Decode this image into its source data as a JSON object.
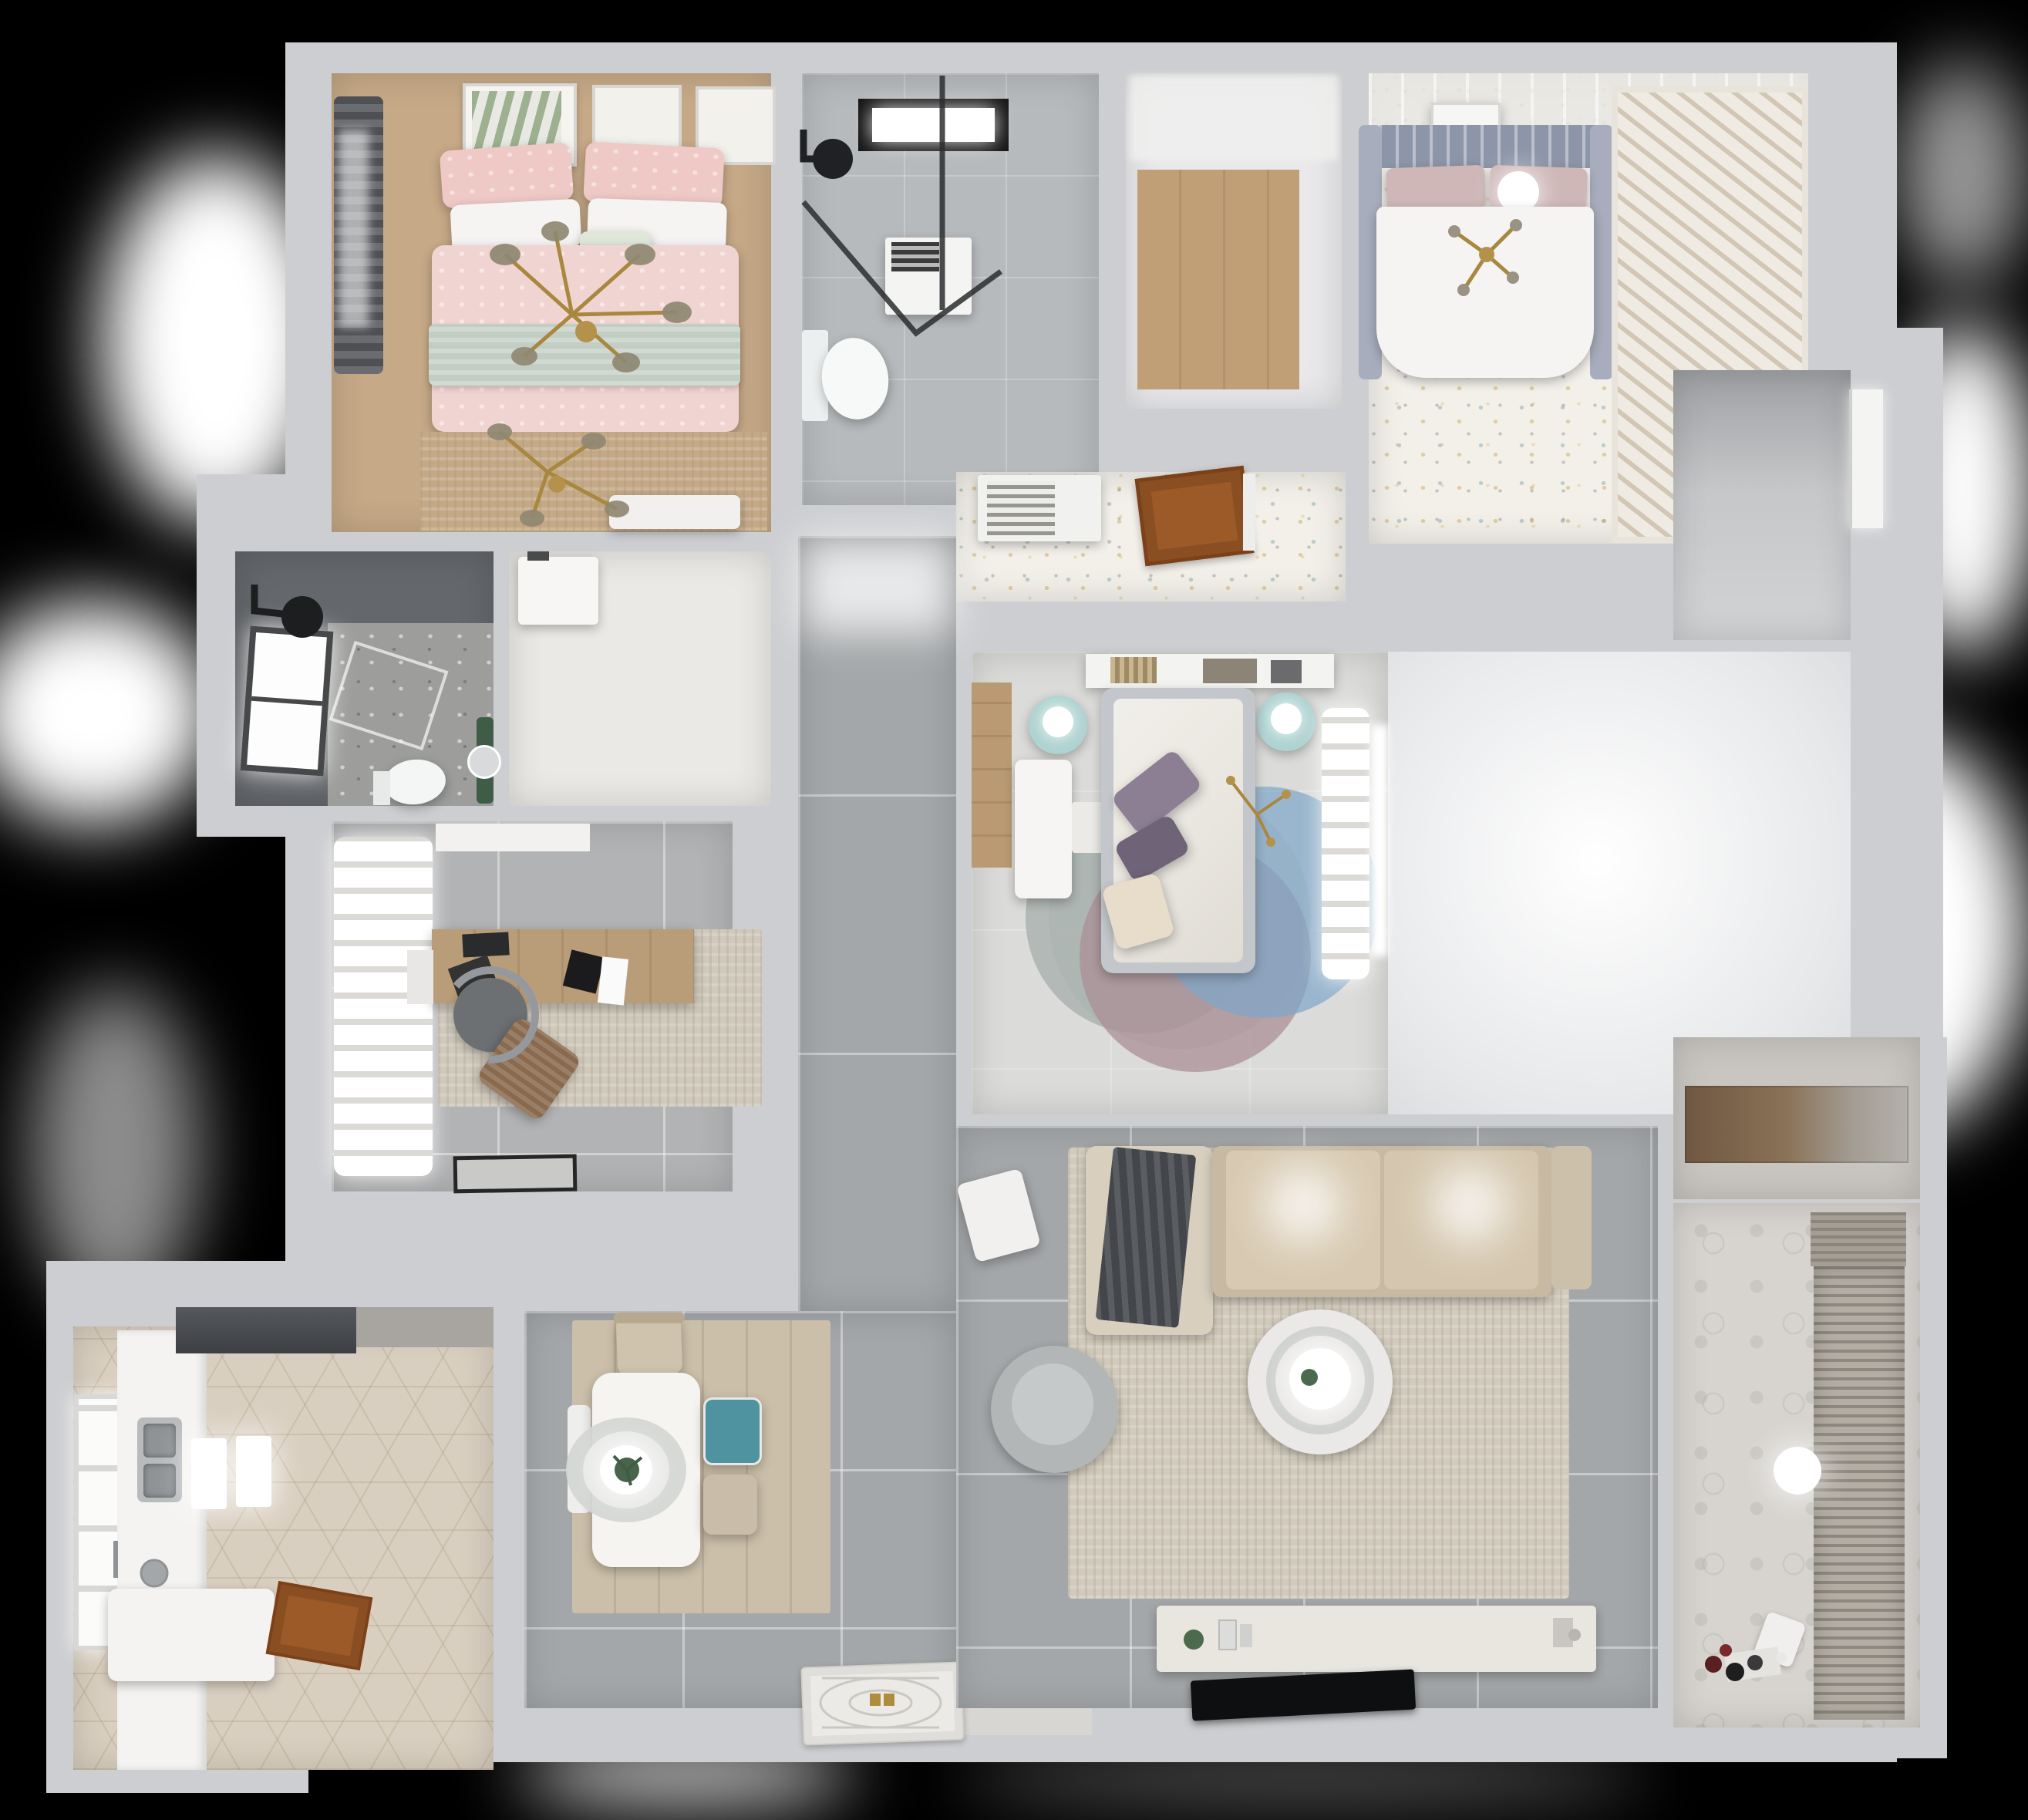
{
  "scene": {
    "description": "Top-down 3D rendered dollhouse floor plan of a furnished apartment on a black background",
    "background_color": "#000000",
    "visible_text": "none"
  },
  "palette": {
    "bg": "#000000",
    "wall": "#cdced1",
    "wallLight": "#e9e9eb",
    "woodFloor": "#c6a987",
    "woodFloor2": "#c09e76",
    "tileGray": "#a4a7a9",
    "tileLight": "#b7babd",
    "tileStudy": "#b2b3b4",
    "bedroom3Floor": "#dbdbd9",
    "darkTile": "#64676b",
    "terrazzoBase": "#9d9e9c",
    "speckleBase": "#f3f0ea",
    "kitchenFloor": "#d9cfc0",
    "balconyFloor": "#d7d4d0",
    "rugTan": "#c5a987",
    "rugBeige": "#cfc8bb",
    "livingRug": "#d2cbbd",
    "pinkDuvet": "#f0d4d1",
    "pinkPillow": "#eec9c6",
    "sageBlanket": "#c2cdc3",
    "whiteSoft": "#f5f4f2",
    "sofaTan": "#c8baa2",
    "sofaChaise": "#d8cfbf",
    "blanketDark": "#43464a",
    "tealChair": "#4f93a0",
    "chairBeige": "#c9bda9",
    "tealStand": "#aed3d1",
    "purplePillow": "#8d7f93",
    "purplePillow2": "#6f6377",
    "creamPillow": "#e8dccb",
    "gold": "#b5924c",
    "doorBrown": "#9c5a28",
    "deskWood": "#b99d79",
    "monitorBlack": "#1b1b1d",
    "hoodDark": "#4b4e52",
    "glassDark": "#2c2d2f",
    "rugBlue": "#7fa6c9",
    "rugMauve": "#a98f96",
    "rugGrayGreen": "#a7b0ac",
    "plantGreen": "#3f5d46"
  },
  "rooms": [
    {
      "id": "bedroom-1",
      "label": "Bedroom 1 (pink bed)"
    },
    {
      "id": "bathroom-1",
      "label": "Bathroom with skylight"
    },
    {
      "id": "walk-in-closet",
      "label": "Walk-in closet"
    },
    {
      "id": "bedroom-2",
      "label": "Bedroom 2 (white bed)"
    },
    {
      "id": "bedroom-2-entry",
      "label": "Bedroom 2 entry corridor"
    },
    {
      "id": "bedroom-3",
      "label": "Bedroom 3 (round rug)"
    },
    {
      "id": "hallway",
      "label": "Hallway"
    },
    {
      "id": "study",
      "label": "Study"
    },
    {
      "id": "shower-room",
      "label": "Shower room"
    },
    {
      "id": "utility-closet",
      "label": "Utility closet"
    },
    {
      "id": "kitchen",
      "label": "Kitchen"
    },
    {
      "id": "dining-area",
      "label": "Dining area"
    },
    {
      "id": "living-room",
      "label": "Living room"
    },
    {
      "id": "entry",
      "label": "Entry door area"
    },
    {
      "id": "storage-niche",
      "label": "Storage niche"
    },
    {
      "id": "balcony",
      "label": "Balcony / laundry"
    },
    {
      "id": "side-room",
      "label": "Side room with white door"
    }
  ]
}
